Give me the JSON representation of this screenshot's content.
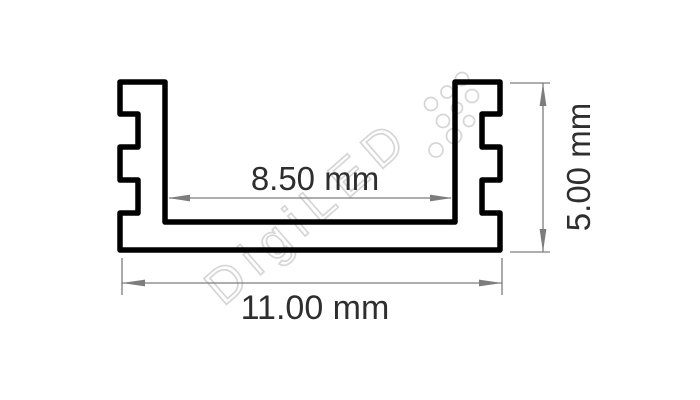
{
  "drawing": {
    "watermark": {
      "text": "DigiLED"
    },
    "dimensions": {
      "inner_width": {
        "label": "8.50 mm",
        "value": 8.5,
        "unit": "mm"
      },
      "outer_width": {
        "label": "11.00 mm",
        "value": 11.0,
        "unit": "mm"
      },
      "height": {
        "label": "5.00 mm",
        "value": 5.0,
        "unit": "mm"
      }
    },
    "colors": {
      "outline": "#000000",
      "dimension_lines": "#7d7d7d",
      "dimension_text": "#2e2e2e",
      "watermark": "#d4d4d4",
      "background": "#ffffff"
    }
  }
}
